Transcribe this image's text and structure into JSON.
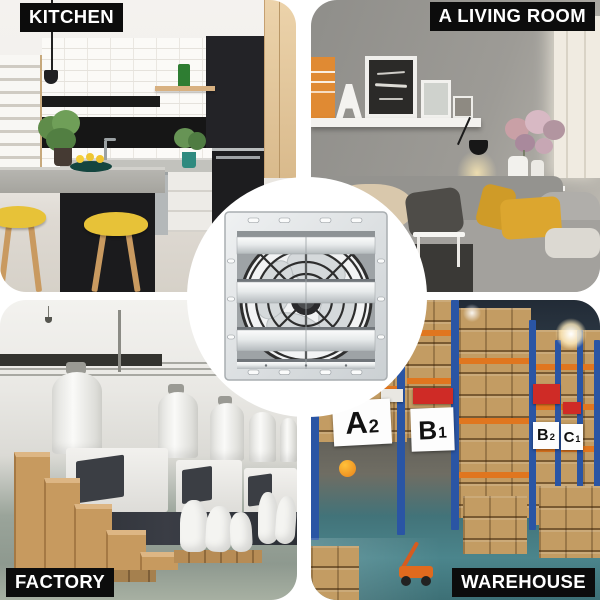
{
  "image_type": "product application scene collage",
  "scenes": [
    {
      "id": "kitchen",
      "label": "KITCHEN",
      "position": "top-left"
    },
    {
      "id": "living-room",
      "label": "A LIVING ROOM",
      "position": "top-right"
    },
    {
      "id": "factory",
      "label": "FACTORY",
      "position": "bottom-left"
    },
    {
      "id": "warehouse",
      "label": "WAREHOUSE",
      "position": "bottom-right"
    }
  ],
  "center_product": {
    "name": "shutter exhaust fan",
    "finish": "silver aluminum",
    "view": "front, louvered shutter over fan blades"
  },
  "warehouse_signs": [
    {
      "letter": "A",
      "sub": "2"
    },
    {
      "letter": "B",
      "sub": "1"
    },
    {
      "letter": "B",
      "sub": "2"
    },
    {
      "letter": "C",
      "sub": "1"
    }
  ],
  "colors": {
    "label_bg": "#0c0c0c",
    "label_text": "#ffffff",
    "background_white": "#ffffff",
    "fan_metal_light": "#eef0f1",
    "fan_metal_dark": "#c2c6c9",
    "fan_guard": "#2d2d2d",
    "rack_blue": "#2a55a4",
    "beam_orange": "#e0761f",
    "cardboard_tan": "#c39c63",
    "sign_red": "#cf2b26",
    "floor_teal": "#44818a",
    "pillow_mustard": "#dca62f",
    "stool_yellow": "#e7c238",
    "wood_step": "#c79a5f"
  }
}
